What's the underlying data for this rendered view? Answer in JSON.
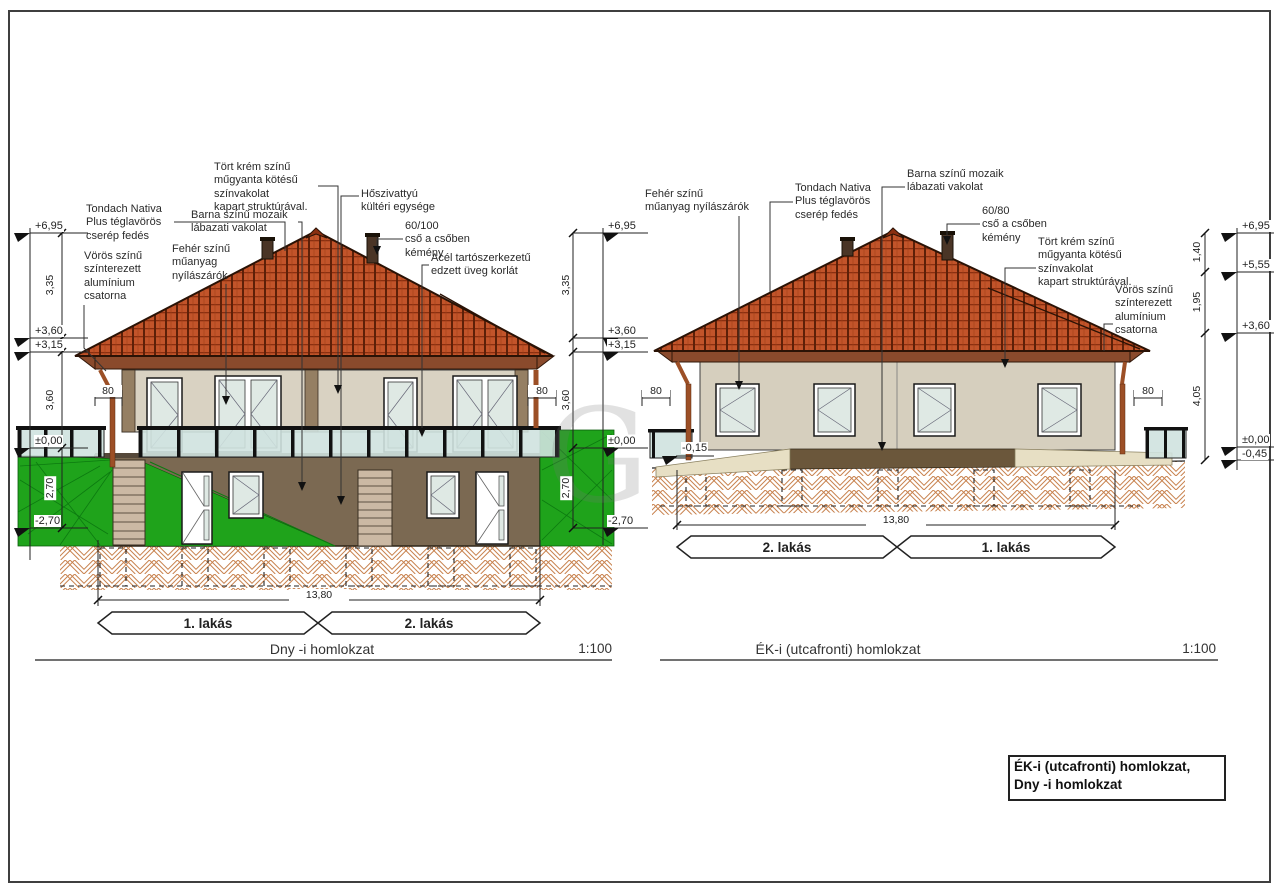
{
  "left": {
    "title": "Dny -i homlokzat",
    "scale": "1:100",
    "width_dim": "13,80",
    "eave_dim": "80",
    "banners": {
      "b1": "1. lakás",
      "b2": "2. lakás"
    },
    "levels": {
      "l695": "+6,95",
      "l360": "+3,60",
      "l315": "+3,15",
      "l000": "±0,00",
      "lm270": "-2,70"
    },
    "dims": {
      "d335": "3,35",
      "d360": "3,60",
      "d270": "2,70"
    },
    "ann": {
      "tondach": "Tondach Nativa\nPlus téglavörös\ncserép fedés",
      "csatorna": "Vörös színű\nszínterezett\nalumínium\ncsatorna",
      "vakolat": "Tört krém színű\nműgyanta kötésű\nszínvakolat\nkapart struktúrával.",
      "labazat": "Barna színű mozaik\nlábazati vakolat",
      "nyilaszaro": "Fehér színű\nműanyag\nnyílászárók",
      "hoszivattyu": "Hőszivattyú\nkültéri egysége",
      "kemeny": "60/100\ncső a csőben\nkémény",
      "korlat": "Acél tartószerkezetű\nedzett üveg korlát"
    }
  },
  "right": {
    "title": "ÉK-i (utcafronti) homlokzat",
    "scale": "1:100",
    "width_dim": "13,80",
    "eave_dim": "80",
    "banners": {
      "b1": "2. lakás",
      "b2": "1. lakás"
    },
    "levels": {
      "l695": "+6,95",
      "l555": "+5,55",
      "l360": "+3,60",
      "l000": "±0,00",
      "lm045": "-0,45",
      "lm015": "-0,15"
    },
    "dims": {
      "d140": "1,40",
      "d195": "1,95",
      "d405": "4,05"
    },
    "ann": {
      "nyilaszaro": "Fehér színű\nműanyag nyílászárók",
      "tondach": "Tondach Nativa\nPlus téglavörös\ncserép fedés",
      "labazat": "Barna színű mozaik\nlábazati vakolat",
      "kemeny": "60/80\ncső a csőben\nkémény",
      "vakolat": "Tört krém színű\nműgyanta kötésű\nszínvakolat\nkapart struktúrával.",
      "csatorna": "Vörös színű\nszínterezett\nalumínium\ncsatorna"
    }
  },
  "titleblock": {
    "text": "ÉK-i (utcafronti) homlokzat,\nDny -i homlokzat"
  },
  "watermark": {
    "letter": "G"
  }
}
